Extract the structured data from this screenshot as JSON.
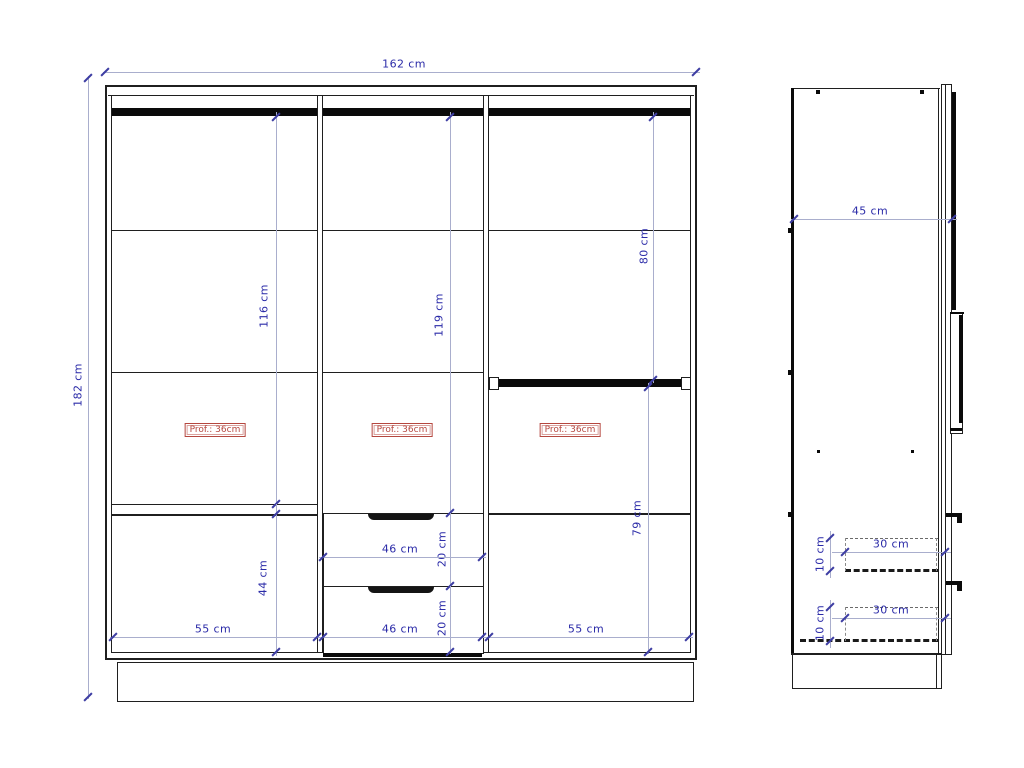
{
  "front_view": {
    "total_width": "162 cm",
    "total_height": "182 cm",
    "left_section": {
      "interior_height": "116 cm",
      "bottom_section_height": "44 cm",
      "width": "55 cm",
      "depth_label": "Prof.: 36cm"
    },
    "middle_section": {
      "interior_height": "119 cm",
      "depth_label": "Prof.: 36cm",
      "drawer_top": {
        "width": "46 cm",
        "height": "20 cm"
      },
      "drawer_bottom": {
        "width": "46 cm",
        "height": "20 cm"
      }
    },
    "right_section": {
      "upper_hanging_height": "80 cm",
      "lower_section_height": "79 cm",
      "width": "55 cm",
      "depth_label": "Prof.: 36cm"
    }
  },
  "side_view": {
    "depth": "45 cm",
    "drawer_top": {
      "depth": "30 cm",
      "height": "10 cm"
    },
    "drawer_bottom": {
      "depth": "30 cm",
      "height": "10 cm"
    }
  },
  "colors": {
    "outline": "#1f1f1f",
    "rail": "#0a0a0a",
    "dimension_text": "#2b2ba8",
    "dimension_line": "#a9aecd",
    "dimension_tick": "#3d3da3",
    "depth_badge": "#b5473f",
    "background": "#ffffff"
  }
}
